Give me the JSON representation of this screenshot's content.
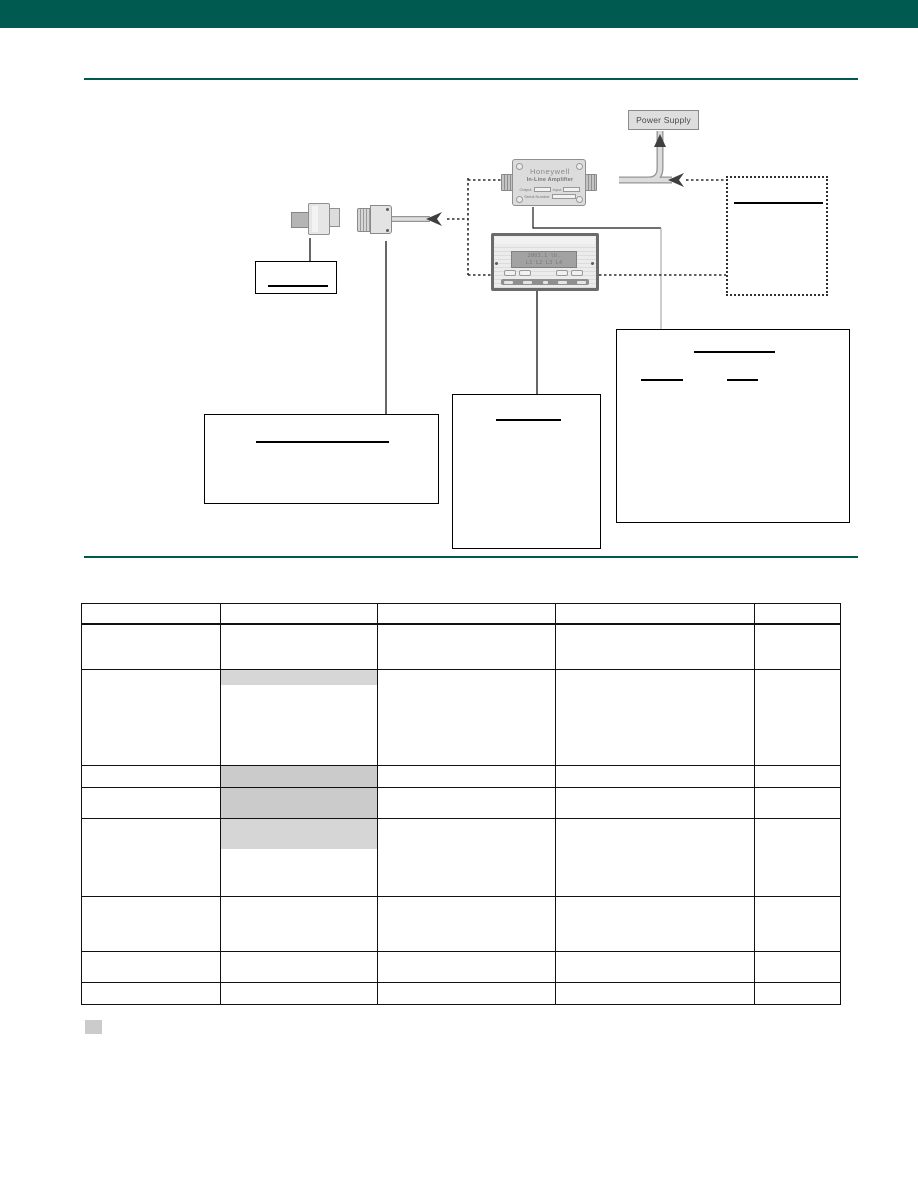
{
  "page": {
    "banner_color": "#005a50",
    "rule_color": "#005a50"
  },
  "diagram": {
    "power_supply": {
      "label": "Power Supply"
    },
    "amplifier": {
      "brand": "Honeywell",
      "name": "In-Line Amplifier",
      "label_output": "Output",
      "label_input": "Input",
      "label_serial": "Serial Number"
    },
    "display": {
      "lcd_line1": "2003.1 lb.",
      "lcd_line2": "L1 L2 L3 L4"
    },
    "callout_boxes_note_text": ""
  },
  "table": {
    "header_height": 20,
    "col_widths": [
      139,
      157,
      178,
      199,
      86
    ],
    "columns": [
      "",
      "",
      "",
      "",
      ""
    ],
    "rows": [
      {
        "height": 46,
        "cells": [
          "",
          "",
          "",
          "",
          ""
        ]
      },
      {
        "height": 96,
        "cells": [
          "",
          "",
          "",
          "",
          ""
        ],
        "shade": {
          "col": 1,
          "mode": "band",
          "band_height": 15
        }
      },
      {
        "height": 22,
        "cells": [
          "",
          "",
          "",
          "",
          ""
        ],
        "shade": {
          "col": 1,
          "mode": "full"
        }
      },
      {
        "height": 31,
        "cells": [
          "",
          "",
          "",
          "",
          ""
        ],
        "shade": {
          "col": 1,
          "mode": "full"
        }
      },
      {
        "height": 78,
        "cells": [
          "",
          "",
          "",
          "",
          ""
        ],
        "shade": {
          "col": 1,
          "mode": "band",
          "band_height": 30
        }
      },
      {
        "height": 55,
        "cells": [
          "",
          "",
          "",
          "",
          ""
        ]
      },
      {
        "height": 31,
        "cells": [
          "",
          "",
          "",
          "",
          ""
        ]
      },
      {
        "height": 22,
        "cells": [
          "",
          "",
          "",
          "",
          ""
        ]
      }
    ]
  },
  "legend": {
    "swatch_color": "#cbcbcb",
    "label": ""
  }
}
